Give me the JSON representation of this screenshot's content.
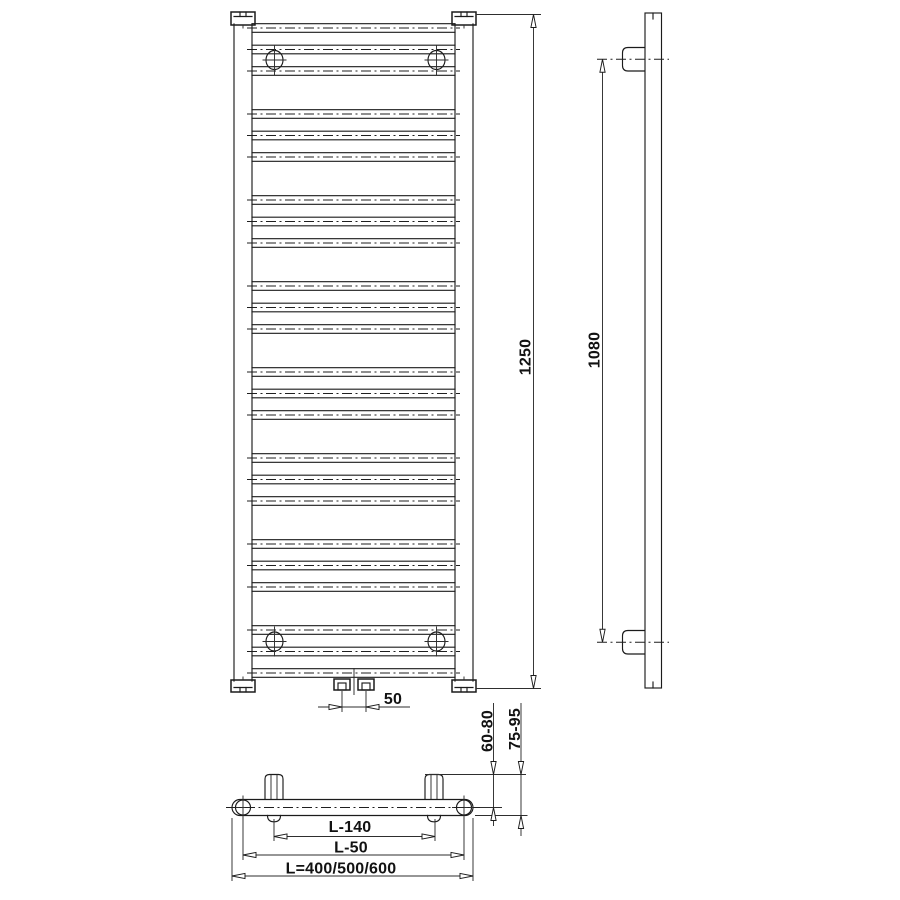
{
  "drawing": {
    "type": "technical dimension drawing",
    "subject": "ladder towel radiator - front elevation, side view and plan view",
    "dimensions": {
      "overall_height": "1250",
      "bracket_height_span": "1080",
      "valve_spacing": "50",
      "wall_to_tube_axis": "60-80",
      "wall_to_front_face": "75-95",
      "bracket_width_span": "L-140",
      "collector_axis_span": "L-50",
      "overall_width": "L=400/500/600"
    }
  },
  "figure": {
    "rung_pattern": {
      "groups": 8,
      "rungs_per_group": 3,
      "first_center_y": 28,
      "pitch": 21.5,
      "group_step": 86
    }
  }
}
